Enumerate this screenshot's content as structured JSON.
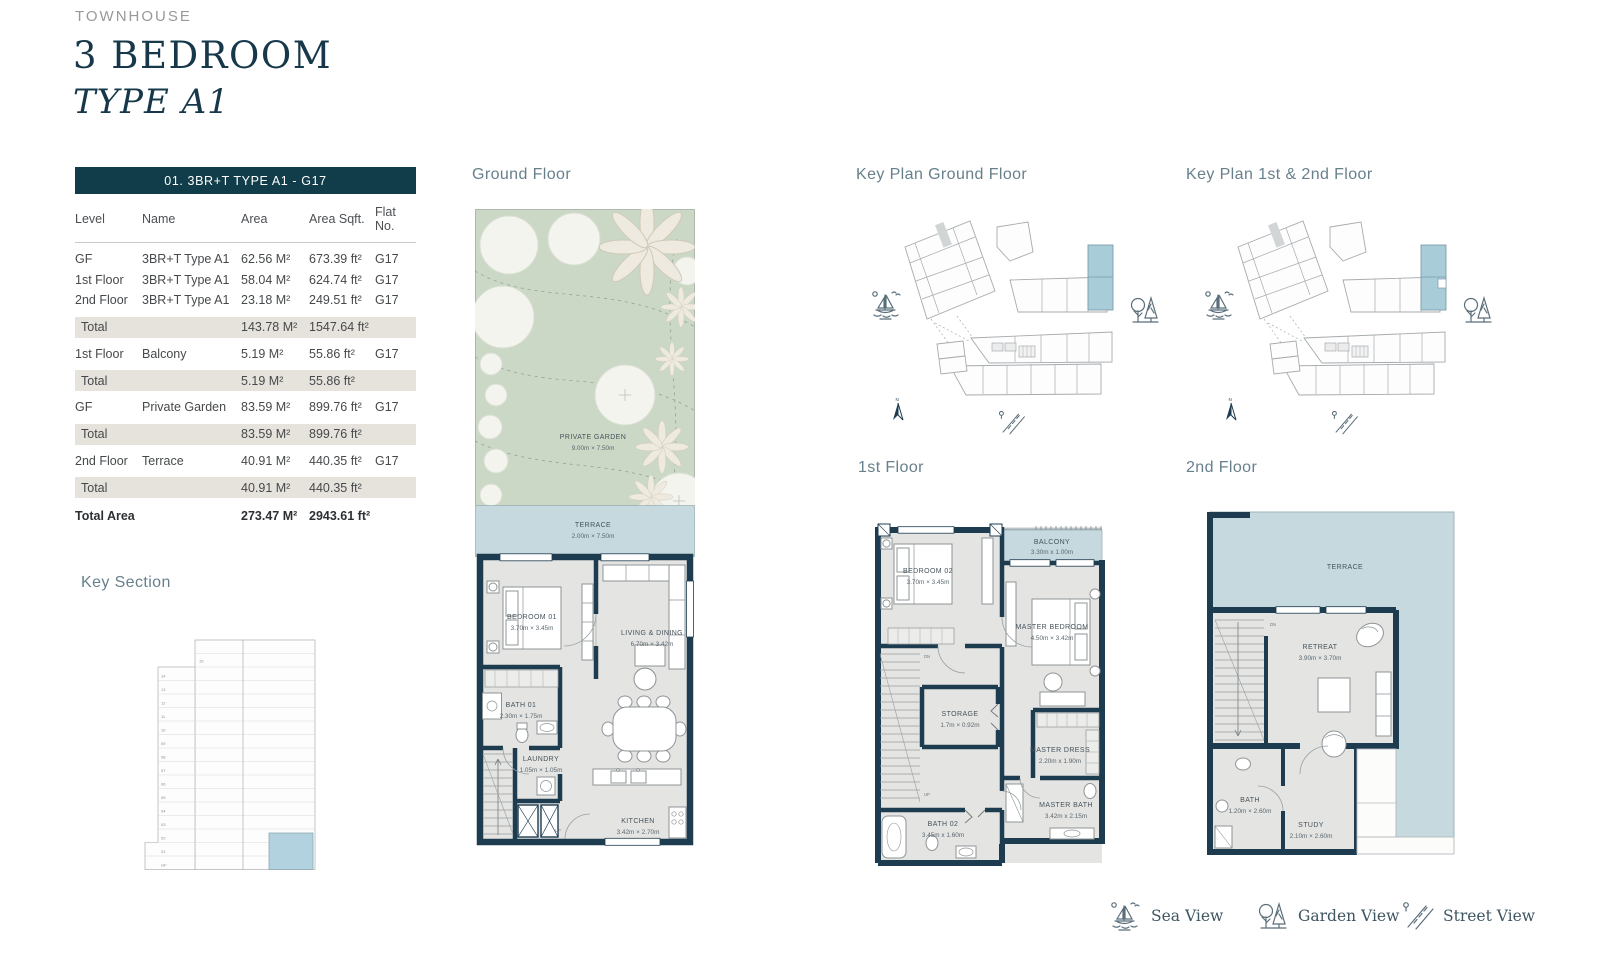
{
  "page": {
    "category": "TOWNHOUSE",
    "title": "3 BEDROOM",
    "subtitle": "TYPE A1"
  },
  "unit_table": {
    "title": "01. 3BR+T TYPE A1 - G17",
    "columns": [
      "Level",
      "Name",
      "Area",
      "Area Sqft.",
      "Flat No."
    ],
    "rows": [
      {
        "level": "GF",
        "name": "3BR+T Type A1",
        "area": "62.56 M²",
        "sqft": "673.39 ft²",
        "flat": "G17"
      },
      {
        "level": "1st Floor",
        "name": "3BR+T Type A1",
        "area": "58.04 M²",
        "sqft": "624.74 ft²",
        "flat": "G17"
      },
      {
        "level": "2nd Floor",
        "name": "3BR+T Type A1",
        "area": "23.18 M²",
        "sqft": "249.51 ft²",
        "flat": "G17"
      },
      {
        "level": "Total",
        "name": "",
        "area": "143.78 M²",
        "sqft": "1547.64 ft²",
        "flat": ""
      },
      {
        "level": "1st Floor",
        "name": "Balcony",
        "area": "5.19 M²",
        "sqft": "55.86 ft²",
        "flat": "G17"
      },
      {
        "level": "Total",
        "name": "",
        "area": "5.19 M²",
        "sqft": "55.86 ft²",
        "flat": ""
      },
      {
        "level": "GF",
        "name": "Private Garden",
        "area": "83.59 M²",
        "sqft": "899.76 ft²",
        "flat": "G17"
      },
      {
        "level": "Total",
        "name": "",
        "area": "83.59 M²",
        "sqft": "899.76 ft²",
        "flat": ""
      },
      {
        "level": "2nd Floor",
        "name": "Terrace",
        "area": "40.91 M²",
        "sqft": "440.35 ft²",
        "flat": "G17"
      },
      {
        "level": "Total",
        "name": "",
        "area": "40.91 M²",
        "sqft": "440.35 ft²",
        "flat": ""
      },
      {
        "level": "Total Area",
        "name": "",
        "area": "273.47 M²",
        "sqft": "2943.61 ft²",
        "flat": ""
      }
    ]
  },
  "key_section": {
    "heading": "Key Section",
    "tower_label": "15",
    "floors": [
      "14",
      "13",
      "12",
      "11",
      "10",
      "09",
      "08",
      "07",
      "06",
      "05",
      "04",
      "03",
      "02",
      "01",
      "GF"
    ]
  },
  "ground_floor": {
    "heading": "Ground Floor",
    "garden_name": "PRIVATE GARDEN",
    "garden_dims": "9.00m × 7.50m",
    "terrace_name": "TERRACE",
    "terrace_dims": "2.00m × 7.50m",
    "bedroom_name": "BEDROOM 01",
    "bedroom_dims": "3.70m × 3.45m",
    "living_name": "LIVING & DINING",
    "living_dims": "6.70m × 3.42m",
    "bath_name": "BATH 01",
    "bath_dims": "2.30m × 1.75m",
    "laundry_name": "LAUNDRY",
    "laundry_dims": "1.05m × 1.05m",
    "kitchen_name": "KITCHEN",
    "kitchen_dims": "3.42m × 2.70m",
    "up_label": "UP"
  },
  "first_floor": {
    "heading": "1st Floor",
    "bedroom_name": "BEDROOM 02",
    "bedroom_dims": "3.70m × 3.45m",
    "balcony_name": "BALCONY",
    "balcony_dims": "3.30m x 1.00m",
    "master_name": "MASTER BEDROOM",
    "master_dims": "4.50m × 3.42m",
    "storage_name": "STORAGE",
    "storage_dims": "1.7m × 0.92m",
    "dress_name": "MASTER DRESS",
    "dress_dims": "2.20m x 1.90m",
    "mbath_name": "MASTER BATH",
    "mbath_dims": "3.42m x 2.15m",
    "bath_name": "BATH 02",
    "bath_dims": "3.45m x 1.60m",
    "dn_label": "DN",
    "up_label": "UP"
  },
  "second_floor": {
    "heading": "2nd Floor",
    "terrace_name": "TERRACE",
    "retreat_name": "RETREAT",
    "retreat_dims": "3.90m × 3.70m",
    "bath_name": "BATH",
    "bath_dims": "1.20m × 2.60m",
    "study_name": "STUDY",
    "study_dims": "2.10m × 2.60m",
    "dn_label": "DN"
  },
  "key_plans": {
    "ground_heading": "Key Plan Ground Floor",
    "upper_heading": "Key Plan 1st & 2nd Floor"
  },
  "legend": {
    "sea": "Sea View",
    "garden": "Garden View",
    "street": "Street View"
  },
  "colors": {
    "accent": "#113c49",
    "wall": "#1e3c50",
    "garden_green": "#ccd8c6",
    "terrace_blue": "#c5d9de",
    "highlight_blue": "#a9ccd9",
    "total_row_bg": "#e6e3dc"
  }
}
